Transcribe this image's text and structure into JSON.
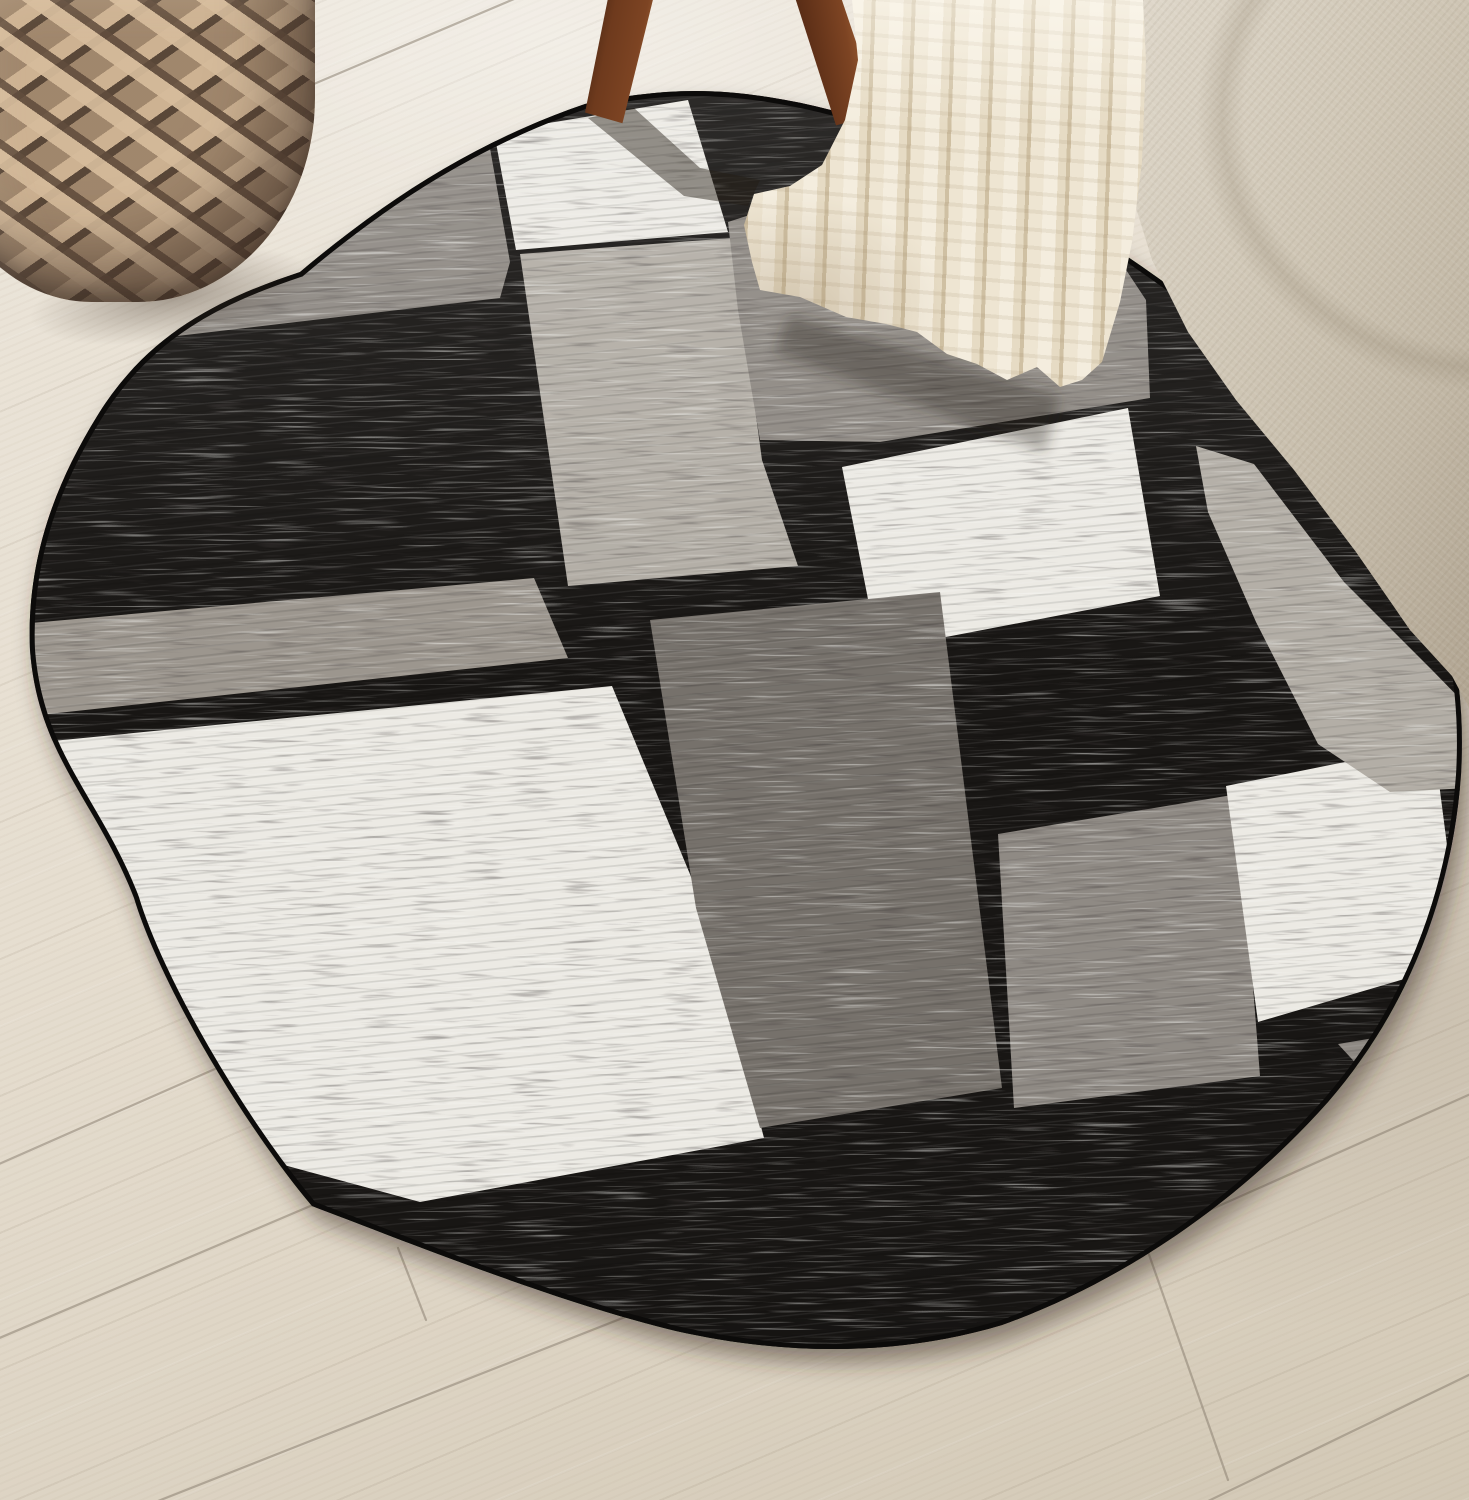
{
  "scene": {
    "description": "Oval geometric color-block area rug in black, gray and white on a light wood plank floor, styled with a tan woven basket, dark walnut stool legs, a cream chunky-knit throw blanket and the corner of a beige linen sofa",
    "aria_label": "Product photo: oval black, gray and white color-block rug in a living room",
    "palette": {
      "floor_light": "#ece6db",
      "floor_mid": "#e6ded0",
      "floor_dark": "#d2c8b5",
      "floor_seam": "#8c8172",
      "rug_black": "#181614",
      "rug_white": "#eceae4",
      "rug_light_gray": "#b3aea6",
      "rug_gray": "#8f8a84",
      "rug_gray_alt": "#9c968e",
      "rug_dark_gray": "#76716b",
      "rug_binding": "#0c0b0a",
      "basket_light": "#cdb292",
      "basket_mid": "#977f66",
      "basket_dark": "#604c3c",
      "leg_dark": "#3c1f0f",
      "leg_mid": "#7d4423",
      "leg_light": "#a96a3b",
      "sofa_light": "#e0d9cc",
      "sofa_mid": "#cfc6b5",
      "sofa_dark": "#b2a693",
      "blanket_light": "#f4edde",
      "blanket_mid": "#e6dbc4",
      "blanket_dark": "#cfc0a3",
      "shadow": "rgba(45,36,26,0.45)"
    },
    "objects": [
      {
        "name": "wood-floor",
        "label": "Light oak plank floor"
      },
      {
        "name": "area-rug",
        "label": "Oval black, gray and white color-block rug"
      },
      {
        "name": "woven-basket",
        "label": "Tan woven yarn basket"
      },
      {
        "name": "stool-legs",
        "label": "Dark walnut stool legs"
      },
      {
        "name": "sofa",
        "label": "Beige linen sofa corner"
      },
      {
        "name": "throw-blanket",
        "label": "Cream chunky knit throw draped onto the rug"
      }
    ]
  },
  "rug": {
    "outline": "M 300 272 C 390 196 480 140 585 104 C 660 88 710 88 768 97 C 865 112 948 148 1012 186 C 1150 262 1320 386 1404 522 C 1452 606 1466 688 1461 775 C 1452 898 1406 1012 1328 1102 C 1238 1203 1122 1282 1002 1325 C 898 1356 788 1356 676 1331 C 556 1302 410 1243 312 1206 C 238 1118 158 978 134 898 C 96 800 38 756 30 650 C 26 556 58 480 96 418 C 148 332 222 298 300 272 Z",
    "blocks": [
      {
        "name": "block-top-left-gray",
        "color_key": "rug_gray",
        "points": "150,155 484,114 510,262 500,298 160,338"
      },
      {
        "name": "block-top-white",
        "color_key": "rug_white",
        "points": "494,132 688,100 728,232 516,250"
      },
      {
        "name": "block-center-light-gray",
        "color_key": "rug_light_gray",
        "points": "520,254 732,238 762,460 798,566 568,586"
      },
      {
        "name": "block-upper-right-gray",
        "color_key": "rug_gray",
        "points": "728,222 870,176 1060,170 1146,300 1150,398 880,442 760,440 738,310"
      },
      {
        "name": "block-right-white",
        "color_key": "rug_white",
        "points": "842,467 1128,408 1160,596 878,650"
      },
      {
        "name": "block-left-gray-band",
        "color_key": "rug_gray_alt",
        "points": "20,624 534,578 568,658 30,716"
      },
      {
        "name": "block-bottom-left-white",
        "color_key": "rug_white",
        "points": "22,744 612,686 704,908 764,1138 420,1202 0,1088"
      },
      {
        "name": "block-center-dark-gray",
        "color_key": "rug_dark_gray",
        "points": "650,620 940,592 1002,1088 760,1128 696,908"
      },
      {
        "name": "block-bottom-gray",
        "color_key": "rug_gray",
        "points": "998,834 1238,794 1260,1076 1014,1108"
      },
      {
        "name": "block-bottom-right-white",
        "color_key": "rug_white",
        "points": "1226,786 1434,744 1462,962 1258,1022"
      },
      {
        "name": "block-right-edge-gray",
        "color_key": "rug_light_gray",
        "points": "1196,446 1254,464 1344,582 1432,670 1469,708 1469,788 1390,792 1318,744 1256,622 1208,512"
      },
      {
        "name": "block-corner-gray-triangle",
        "color_key": "rug_gray",
        "points": "1338,1044 1410,1032 1386,1096"
      }
    ],
    "shadows": [
      {
        "name": "left-leg-shadow",
        "points": "588,118 634,108 700,168 760,180 748,206 684,196",
        "opacity": 0.45,
        "blur": false
      },
      {
        "name": "right-leg-shadow",
        "points": "846,116 890,108 1000,152 986,178",
        "opacity": 0.3,
        "blur": false
      },
      {
        "name": "blanket-shadow",
        "points": "790,315 1060,395 1045,452 775,352",
        "opacity": 0.35,
        "blur": true
      }
    ]
  },
  "floor": {
    "seams": [
      {
        "x1": 295,
        "y1": 92,
        "x2": 540,
        "y2": -12
      },
      {
        "x1": -10,
        "y1": 256,
        "x2": 95,
        "y2": 212
      },
      {
        "x1": -10,
        "y1": 1168,
        "x2": 385,
        "y2": 994
      },
      {
        "x1": -10,
        "y1": 1342,
        "x2": 348,
        "y2": 1190
      },
      {
        "x1": 148,
        "y1": 1505,
        "x2": 648,
        "y2": 1308
      },
      {
        "x1": 980,
        "y1": 1312,
        "x2": 1475,
        "y2": 1092
      },
      {
        "x1": 1200,
        "y1": 1505,
        "x2": 1475,
        "y2": 1372
      },
      {
        "x1": 398,
        "y1": 1248,
        "x2": 426,
        "y2": 1320
      },
      {
        "x1": 1146,
        "y1": 1246,
        "x2": 1228,
        "y2": 1480
      }
    ]
  }
}
